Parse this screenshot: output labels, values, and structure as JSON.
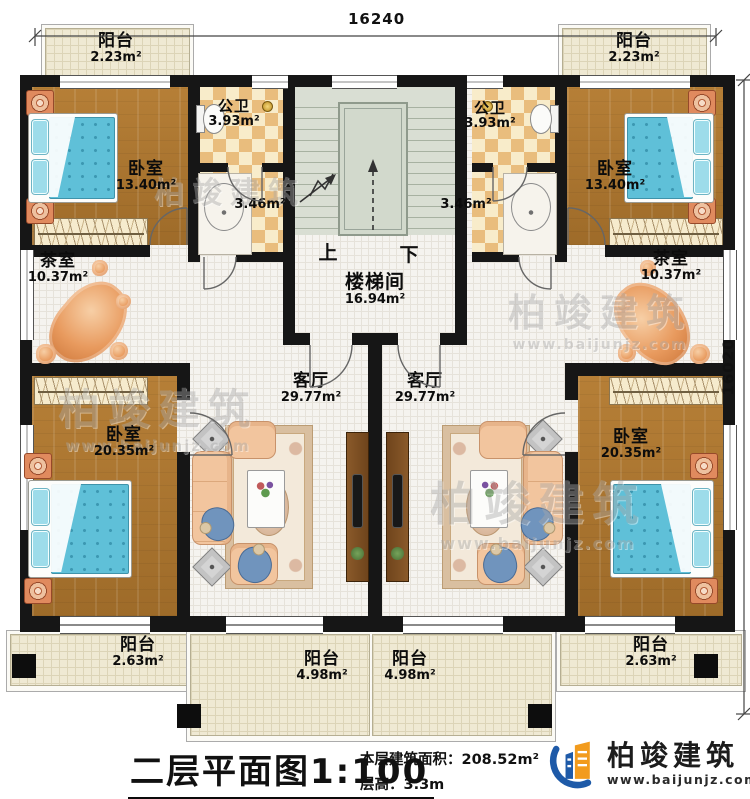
{
  "dimensions": {
    "width": "16240",
    "height": "16020"
  },
  "rooms": {
    "balcony_tl": {
      "name": "阳台",
      "area": "2.23m²"
    },
    "balcony_tr": {
      "name": "阳台",
      "area": "2.23m²"
    },
    "bedroom_tl": {
      "name": "卧室",
      "area": "13.40m²"
    },
    "bedroom_tr": {
      "name": "卧室",
      "area": "13.40m²"
    },
    "bath_l": {
      "name": "公卫",
      "area": "3.93m²"
    },
    "bath_r": {
      "name": "公卫",
      "area": "3.93m²"
    },
    "wash_l": {
      "area": "3.46m²"
    },
    "wash_r": {
      "area": "3.46m²"
    },
    "stairwell": {
      "name": "楼梯间",
      "area": "16.94m²",
      "up": "上",
      "down": "下"
    },
    "tea_l": {
      "name": "茶室",
      "area": "10.37m²"
    },
    "tea_r": {
      "name": "茶室",
      "area": "10.37m²"
    },
    "living_l": {
      "name": "客厅",
      "area": "29.77m²"
    },
    "living_r": {
      "name": "客厅",
      "area": "29.77m²"
    },
    "bedroom_bl": {
      "name": "卧室",
      "area": "20.35m²"
    },
    "bedroom_br": {
      "name": "卧室",
      "area": "20.35m²"
    },
    "balcony_bl": {
      "name": "阳台",
      "area": "2.63m²"
    },
    "balcony_br": {
      "name": "阳台",
      "area": "2.63m²"
    },
    "balcony_bcl": {
      "name": "阳台",
      "area": "4.98m²"
    },
    "balcony_bcr": {
      "name": "阳台",
      "area": "4.98m²"
    }
  },
  "titleblock": {
    "title": "二层平面图",
    "scale": "1:100",
    "area_label": "本层建筑面积：",
    "area_value": "208.52m²",
    "floor_height_label": "层高：",
    "floor_height_value": "3.3m"
  },
  "brand": {
    "name": "柏竣建筑",
    "website": "www.baijunjz.com"
  },
  "watermark": {
    "name": "柏竣建筑",
    "website": "www.baijunjz.com"
  },
  "colors": {
    "wall": "#161616",
    "wood_floor": "#ab7631",
    "bed_blue": "#5fc0d8",
    "checker_tile": "#e9bd7d",
    "balcony_floor": "#efe9d3",
    "stair_floor": "#d9ded3",
    "brand_blue": "#1e5aa8",
    "brand_orange": "#f29b1d"
  }
}
